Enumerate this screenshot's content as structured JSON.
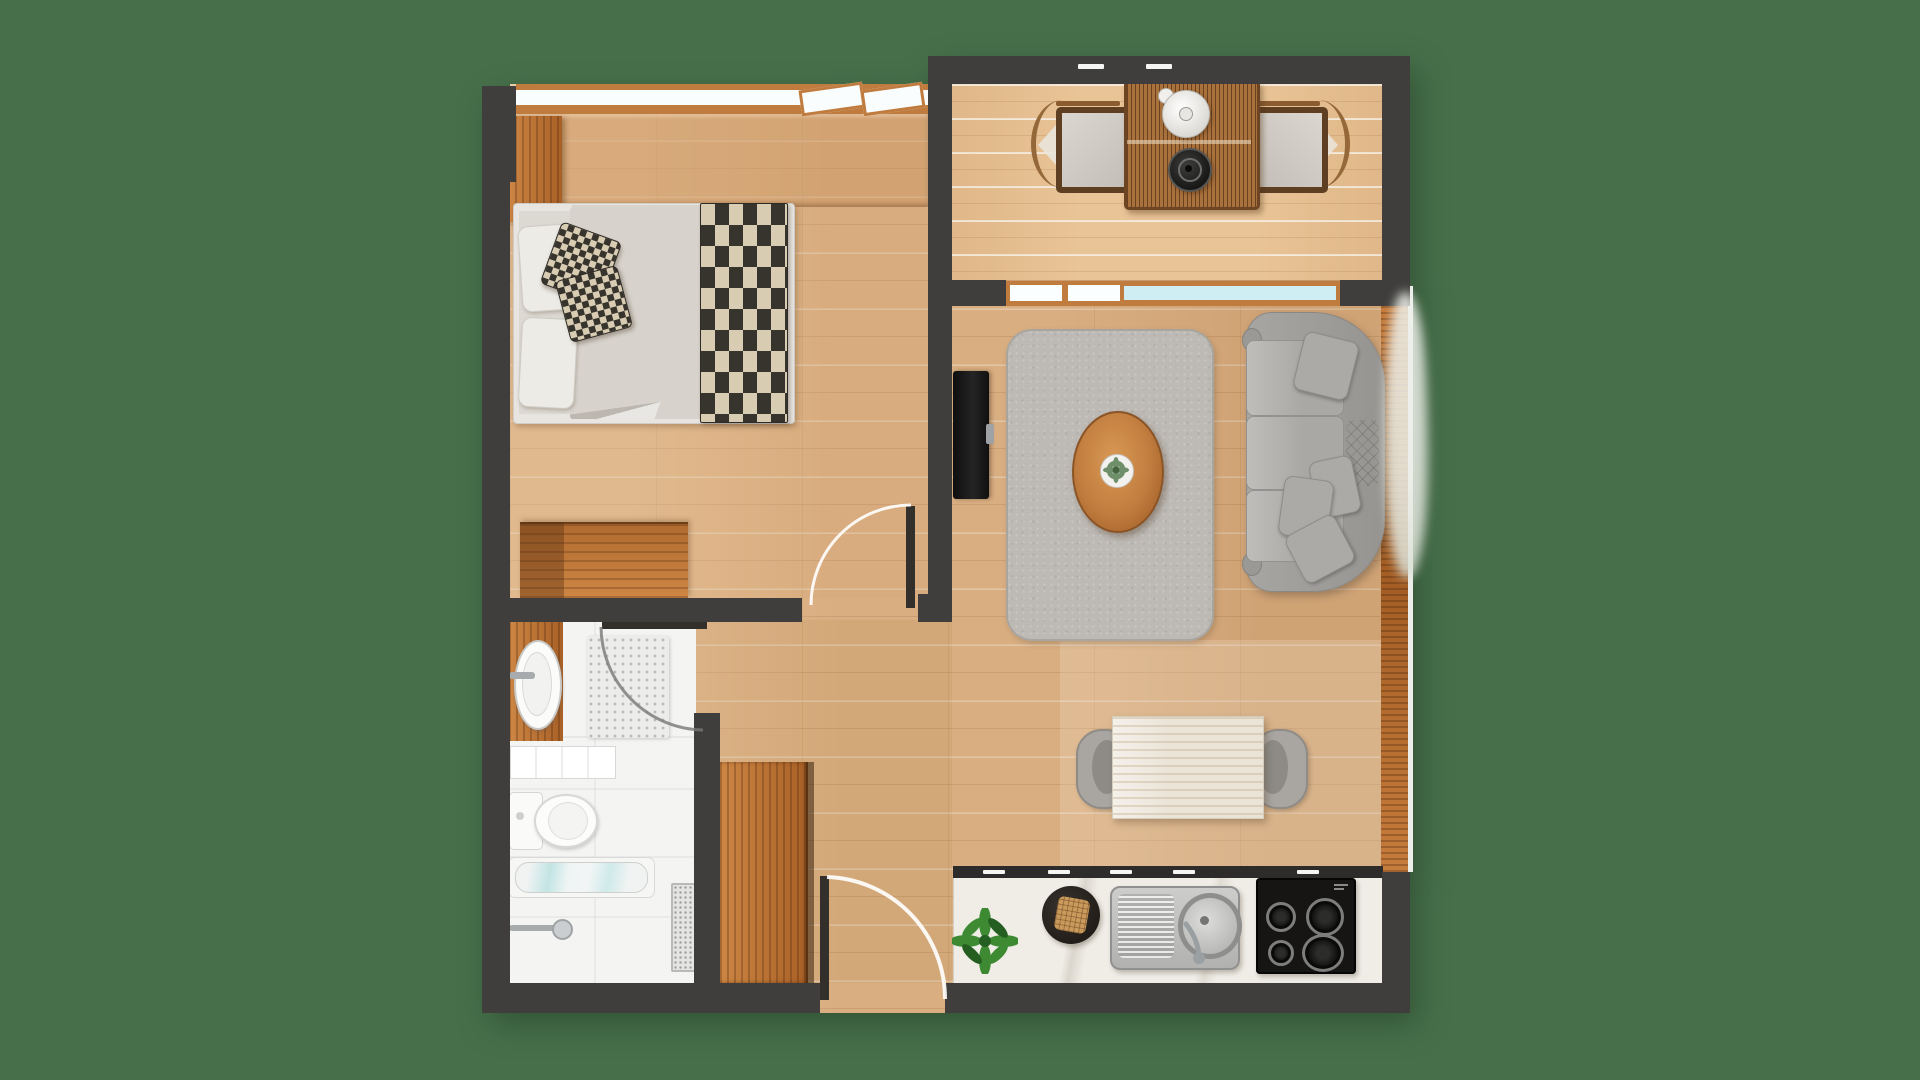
{
  "document": {
    "title": "Apartment Floor Plan — Top-Down 3D Render"
  },
  "palette": {
    "bg": "#47704a",
    "wall": "#3f3e3d",
    "wood": "#d9ae81",
    "deck": "#e9c497",
    "accent": "#c07c3e",
    "accentDark": "#7a4e26",
    "glass": "#cfeef3",
    "tile": "#f4f4f2",
    "rug": "#bdb9b4",
    "sofa": "#a3a19e",
    "cushion": "#abaaa7",
    "linen": "#d7d3cc",
    "checkerDark": "#37332d",
    "checkerCream": "#d8cdb2",
    "counter": "#f0ede7",
    "steel": "#bfbfbd",
    "cooktop": "#161514",
    "plantGreen": "#3e8a33",
    "plantDark": "#245f21",
    "chrome": "#a7abad"
  },
  "rooms": [
    {
      "name": "bedroom",
      "furniture": [
        "double-bed",
        "pillows",
        "checker-cushions",
        "checkered-throw",
        "headboard-panel",
        "dresser",
        "side-panel",
        "door"
      ]
    },
    {
      "name": "balcony",
      "furniture": [
        "rattan-table",
        "teapot",
        "kettle",
        "lounge-chair-left",
        "lounge-chair-right",
        "deck-planks"
      ]
    },
    {
      "name": "living-room",
      "furniture": [
        "sofa",
        "sofa-pillows",
        "rug",
        "oval-coffee-table",
        "table-plant",
        "tv",
        "window-band",
        "wood-ledge"
      ]
    },
    {
      "name": "dining-area",
      "furniture": [
        "dining-table",
        "chair-left",
        "chair-right"
      ]
    },
    {
      "name": "kitchen",
      "furniture": [
        "counter",
        "upper-cabinet-band",
        "herb-plant",
        "cutting-board",
        "bread",
        "sink",
        "faucet",
        "cooktop-4-burners"
      ]
    },
    {
      "name": "bathroom",
      "furniture": [
        "vanity",
        "basin",
        "shower-mat",
        "shelf-unit",
        "toilet",
        "bathtub",
        "towel-rail",
        "floor-drain",
        "door"
      ]
    },
    {
      "name": "hallway",
      "furniture": [
        "tall-cabinet",
        "entrance-door"
      ]
    }
  ],
  "doors": [
    {
      "name": "bedroom-door",
      "state": "open"
    },
    {
      "name": "bathroom-door",
      "state": "open"
    },
    {
      "name": "entrance-door",
      "state": "open"
    }
  ]
}
